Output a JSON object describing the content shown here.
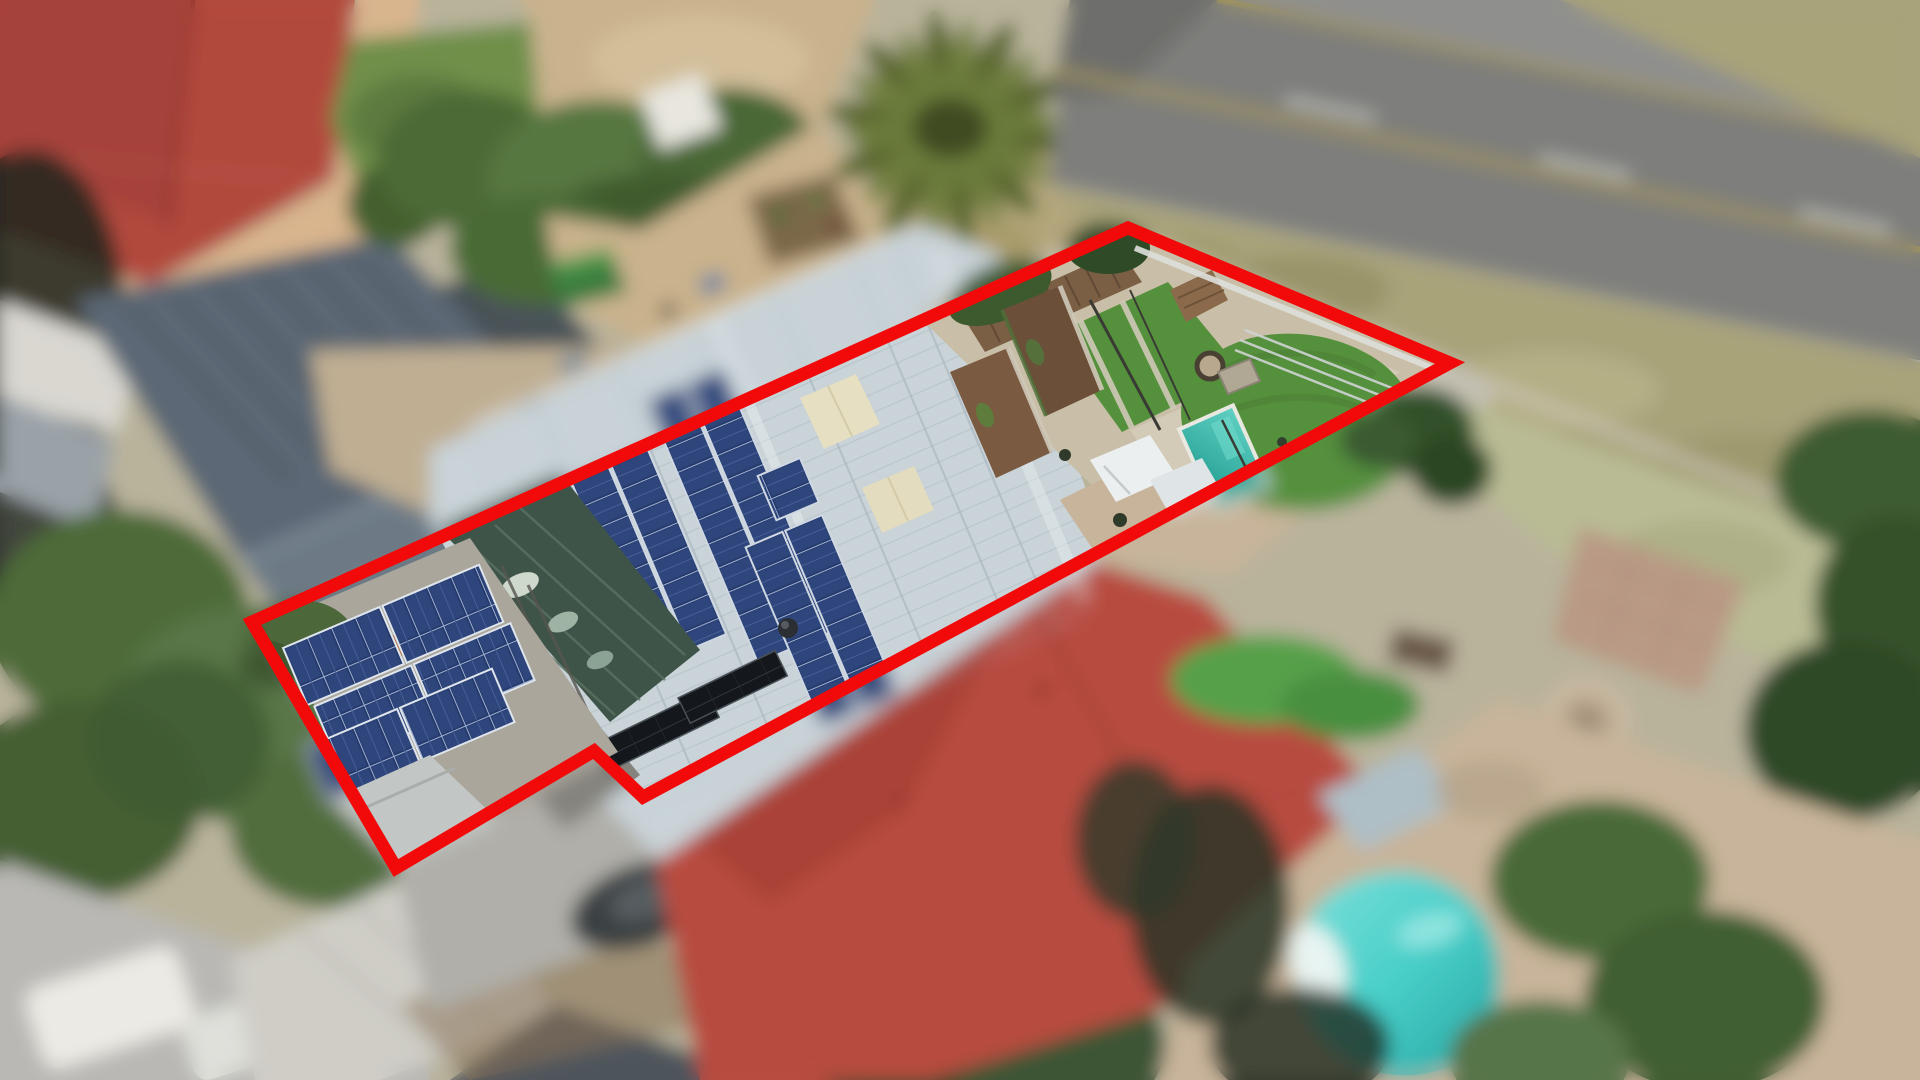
{
  "scene": {
    "kind": "aerial-drone-photo",
    "subject": "suburban-property-with-red-boundary-overlay",
    "annotation": {
      "label": "property-boundary",
      "color": "#f20a0a",
      "stroke_width": 13,
      "points": "252,622 1128,228 1450,363 643,797 594,751 396,868"
    },
    "palette": {
      "base_ground": "#b9b39b",
      "road_asphalt": "#7e7e7c",
      "road_asphalt_light": "#8f8f8d",
      "road_line_yellow": "#a89a52",
      "road_line_white": "#d6d6d0",
      "verge_grass": "#a8a379",
      "lawn_top_left": "#6f8f4a",
      "lawn_backyard": "#55903c",
      "tree_dark": "#3f5c2e",
      "sand_yard": "#c9b28c",
      "tl_red_roof": "#b24a3e",
      "neighbor_gray_roof": "#5c6874",
      "neighbor_red_roof": "#b84b3f",
      "subject_roof_white": "#c9d3d8",
      "weathered_roof": "#84837d",
      "courtyard_green": "#3e5449",
      "solar_panel_navy": "#24386a",
      "solar_thermal_black": "#14181c",
      "cream_roof_patch": "#e6dfc2",
      "soil_bed": "#6b4f38",
      "fence_wood": "#7b5f45",
      "paving_warm": "#c8b49a",
      "concrete": "#b9b8b4",
      "pool_backyard_teal": "#27b1a3",
      "pool_bottom_right_cyan": "#49cfc9"
    },
    "elements": [
      "road",
      "grass-verge",
      "palm-tree",
      "top-left-red-tile-roof",
      "left-neighbor-gray-roof",
      "top-lawn-and-trees",
      "sandy-yard",
      "subject-garage-solar-panels",
      "subject-courtyard-shade-roof",
      "subject-weathered-wing",
      "subject-main-roof",
      "subject-pv-arrays",
      "subject-solar-thermal-collectors",
      "subject-backyard-lawns",
      "subject-garden-beds",
      "subject-plunge-pool",
      "wood-fence",
      "neighbor-red-tile-roof",
      "right-neighbor-yard",
      "fire-pit",
      "bottom-right-pool",
      "driveways-and-cars",
      "hedges-and-trees"
    ]
  }
}
